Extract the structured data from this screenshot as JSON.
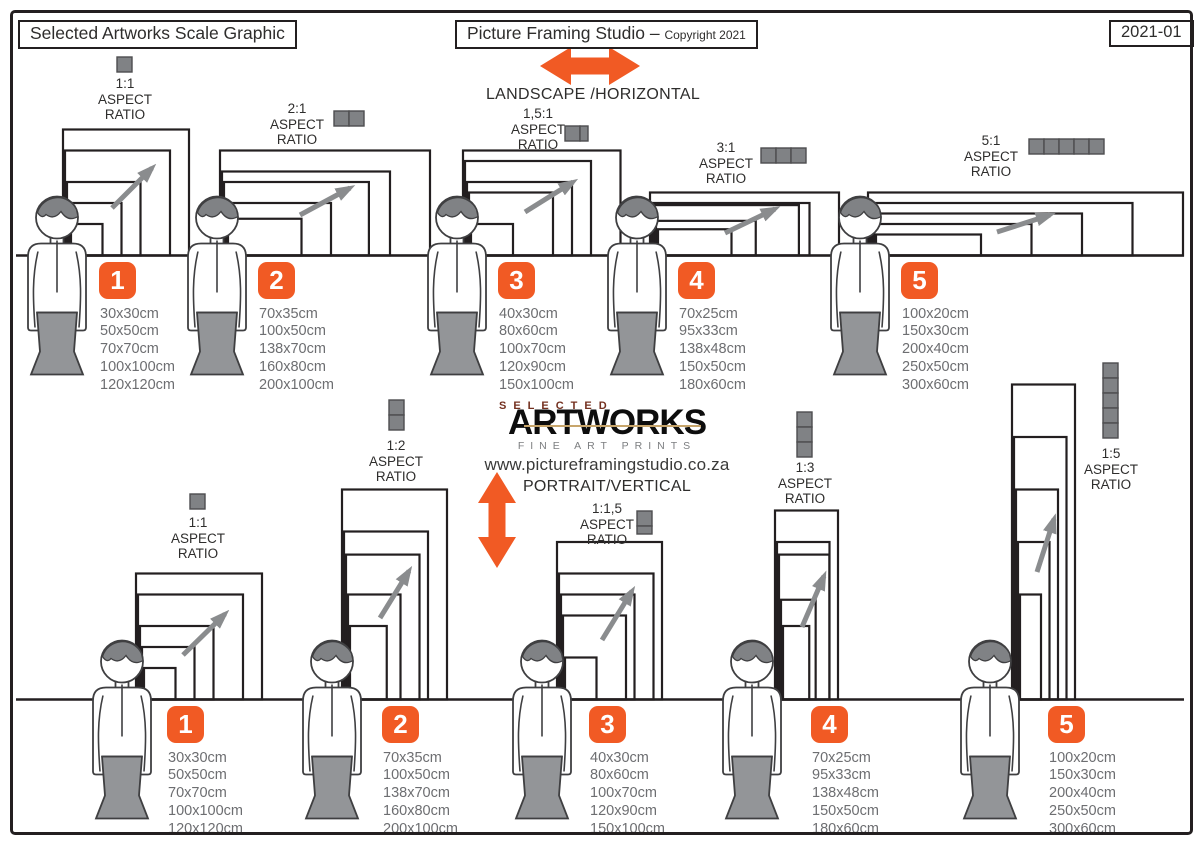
{
  "header": {
    "title": "Selected Artworks Scale Graphic",
    "studio": "Picture Framing Studio –",
    "copyright": "Copyright 2021",
    "version": "2021-01"
  },
  "labels": {
    "aspect": "ASPECT",
    "ratio": "RATIO"
  },
  "logo": {
    "selected": "SELECTED",
    "artworks": "ARTWORKS",
    "tagline": "FINE ART PRINTS",
    "website": "www.pictureframingstudio.co.za"
  },
  "landscape_section": {
    "heading": "LANDSCAPE /HORIZONTAL",
    "groups": [
      {
        "number": "1",
        "ratio": "1:1",
        "ratio_units": 1,
        "sizes": [
          "30x30cm",
          "50x50cm",
          "70x70cm",
          "100x100cm",
          "120x120cm"
        ]
      },
      {
        "number": "2",
        "ratio": "2:1",
        "ratio_units": 2,
        "sizes": [
          "70x35cm",
          "100x50cm",
          "138x70cm",
          "160x80cm",
          "200x100cm"
        ]
      },
      {
        "number": "3",
        "ratio": "1,5:1",
        "ratio_units": 1.5,
        "sizes": [
          "40x30cm",
          "80x60cm",
          "100x70cm",
          "120x90cm",
          "150x100cm"
        ]
      },
      {
        "number": "4",
        "ratio": "3:1",
        "ratio_units": 3,
        "sizes": [
          "70x25cm",
          "95x33cm",
          "138x48cm",
          "150x50cm",
          "180x60cm"
        ]
      },
      {
        "number": "5",
        "ratio": "5:1",
        "ratio_units": 5,
        "sizes": [
          "100x20cm",
          "150x30cm",
          "200x40cm",
          "250x50cm",
          "300x60cm"
        ]
      }
    ]
  },
  "portrait_section": {
    "heading": "PORTRAIT/VERTICAL",
    "groups": [
      {
        "number": "1",
        "ratio": "1:1",
        "ratio_units": 1,
        "sizes": [
          "30x30cm",
          "50x50cm",
          "70x70cm",
          "100x100cm",
          "120x120cm"
        ]
      },
      {
        "number": "2",
        "ratio": "1:2",
        "ratio_units": 2,
        "sizes": [
          "70x35cm",
          "100x50cm",
          "138x70cm",
          "160x80cm",
          "200x100cm"
        ]
      },
      {
        "number": "3",
        "ratio": "1:1,5",
        "ratio_units": 1.5,
        "sizes": [
          "40x30cm",
          "80x60cm",
          "100x70cm",
          "120x90cm",
          "150x100cm"
        ]
      },
      {
        "number": "4",
        "ratio": "1:3",
        "ratio_units": 3,
        "sizes": [
          "70x25cm",
          "95x33cm",
          "138x48cm",
          "150x50cm",
          "180x60cm"
        ]
      },
      {
        "number": "5",
        "ratio": "1:5",
        "ratio_units": 5,
        "sizes": [
          "100x20cm",
          "150x30cm",
          "200x40cm",
          "250x50cm",
          "300x60cm"
        ]
      }
    ]
  },
  "colors": {
    "accent_orange": "#F15A24",
    "line_dark": "#231F20",
    "icon_gray": "#808285",
    "skirt_gray": "#939598",
    "arrow_gray": "#8a8c8e",
    "text_gray": "#6D6E71"
  }
}
